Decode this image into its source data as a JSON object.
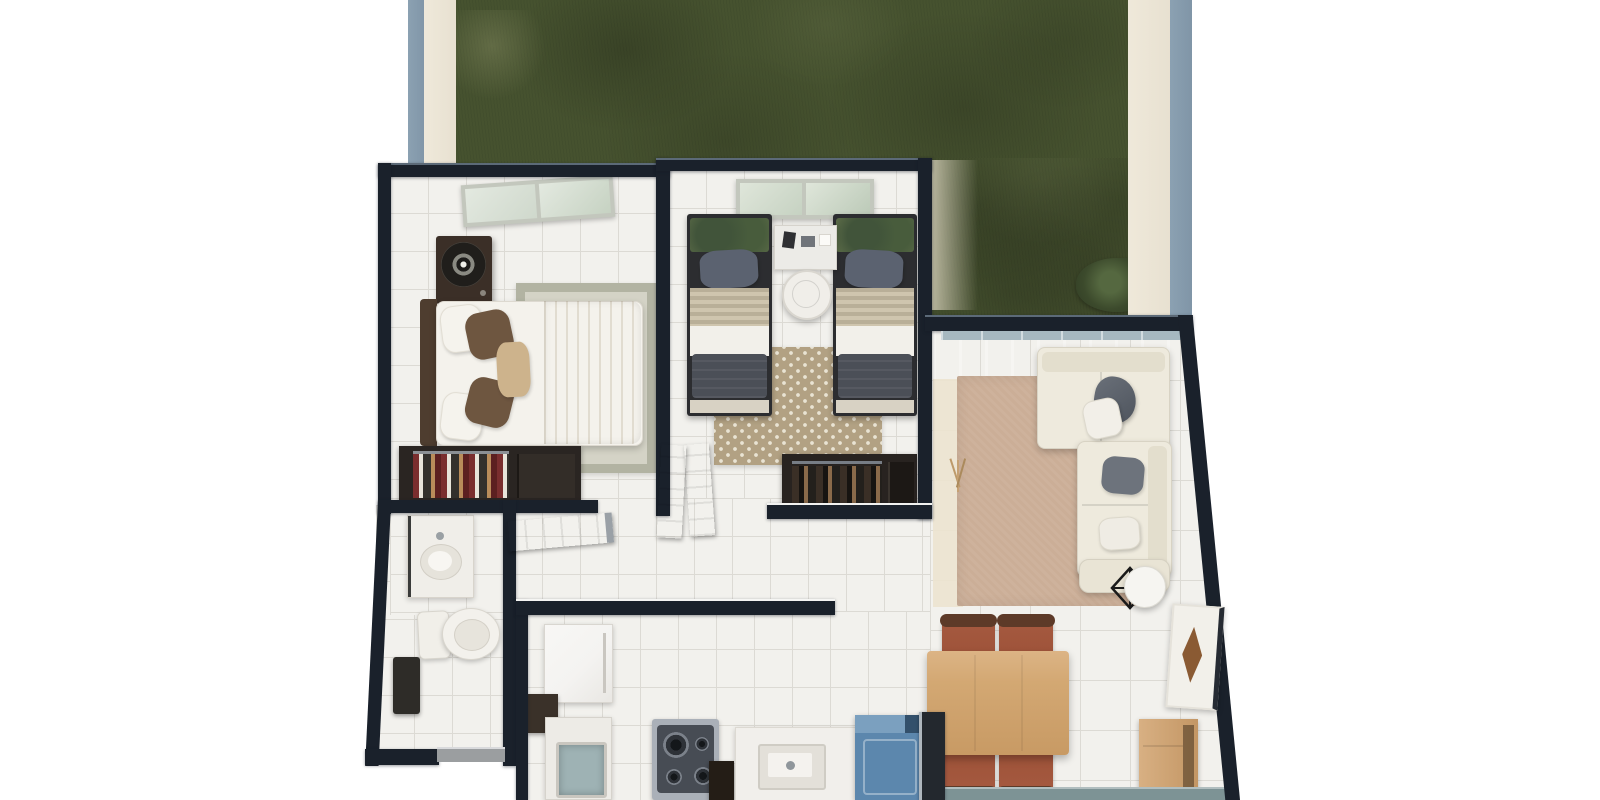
{
  "scene": {
    "description": "3D top-down architectural render of a two-bedroom apartment floor plan with a backyard lawn",
    "background": "#ffffff"
  },
  "palette": {
    "wall_dark": "#1a212b",
    "wall_edge": "#5c6a78",
    "outer_wall_blue": "#8095a7",
    "outer_wall_beige": "#e7e0d0",
    "grass": "#46522f",
    "bush_green": "#3c4a2c",
    "tile": "#f2f1ed",
    "grout": "#dcdad4",
    "rug_living": "#cbae97",
    "rug_bed1_border": "#b2b3a2",
    "rug_bed1_field": "#d4d3c6",
    "rug_bed2": "#b2a183",
    "rug_dots": "#e9e3d3",
    "sofa_cream": "#eeeadd",
    "sofa_shade": "#e3decd",
    "pillow_gray": "#6d737c",
    "pillow_slate": "#5b6270",
    "pillow_brown": "#6e5640",
    "bed_white": "#f4f2ec",
    "blanket_beige": "#e9ddbc",
    "blanket_charcoal": "#4b4f57",
    "headboard_brown": "#4e3d2f",
    "wardrobe_dark": "#282320",
    "wood_table": "#d3a873",
    "chair_seat": "#9c5138",
    "chair_back": "#5d3a28",
    "plant_green": "#5c6c48",
    "glass_band": "#a6b8c0",
    "window_pane": "#dfe6da",
    "window_frame": "#c3c7bd",
    "steel": "#aab0b8",
    "stove_top": "#474c54",
    "washer_blue": "#5c87ad",
    "washer_lid": "#7ba0bf",
    "teal_fixture": "#9eb2b4",
    "teal_wall": "#7d9395",
    "threshold_gray": "#9b9ea0",
    "appliance_white": "#f4f3f1",
    "beige_band": "#e5d9c2",
    "artwork_brown": "#8a5a33",
    "fixture_white": "#f0eee9"
  },
  "rooms": [
    {
      "id": "backyard",
      "items": [
        "lawn",
        "shrub",
        "perimeter-wall"
      ]
    },
    {
      "id": "bedroom-1",
      "items": [
        "window",
        "dresser-with-fan",
        "double-bed",
        "area-rug",
        "wardrobe"
      ]
    },
    {
      "id": "bedroom-2",
      "items": [
        "window",
        "twin-bed-left",
        "twin-bed-right",
        "nightstand",
        "round-side-table",
        "dotted-rug",
        "wardrobe"
      ]
    },
    {
      "id": "living-room",
      "items": [
        "sliding-glass-door",
        "area-rug",
        "sectional-sofa",
        "throw-blanket",
        "cushions",
        "wire-side-table",
        "dried-plant"
      ]
    },
    {
      "id": "dining-area",
      "items": [
        "dining-table",
        "dining-chairs",
        "artwork-panel",
        "sideboard"
      ]
    },
    {
      "id": "kitchen",
      "items": [
        "refrigerator",
        "laundry-tank",
        "gas-stove",
        "sink-counter",
        "washing-machine"
      ]
    },
    {
      "id": "bathroom",
      "items": [
        "vanity-sink",
        "toilet",
        "waste-bin",
        "door-threshold"
      ]
    },
    {
      "id": "hallway",
      "items": [
        "open-door-leaves"
      ]
    }
  ]
}
